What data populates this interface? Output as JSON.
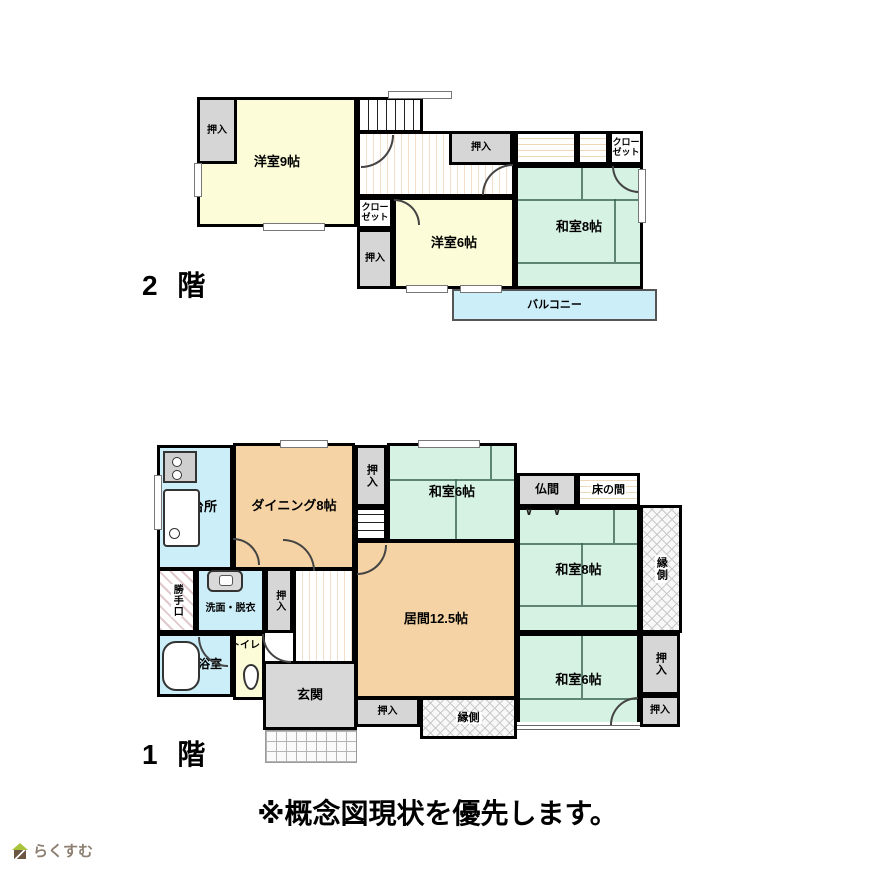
{
  "note": "※概念図現状を優先します。",
  "logo_text": "らくすむ",
  "floor2": {
    "label": "2 階",
    "rooms": {
      "yoshitsu9": "洋室9帖",
      "yoshitsu6": "洋室6帖",
      "washitsu8": "和室8帖",
      "balcony": "バルコニー",
      "closet": "クローゼット",
      "oshiire": "押入"
    }
  },
  "floor1": {
    "label": "1 階",
    "rooms": {
      "kitchen": "台所",
      "dining": "ダイニング8帖",
      "living": "居間12.5帖",
      "washitsu6": "和室6帖",
      "washitsu8": "和室8帖",
      "butsuma": "仏間",
      "butsuma_doors": "∨ ∨",
      "tokonoma": "床の間",
      "engawa": "縁側",
      "oshiire": "押入",
      "kattegu": "勝手口",
      "senmen": "洗面・脱衣",
      "bath": "浴室",
      "toilet": "トイレ",
      "genkan": "玄関"
    }
  },
  "colors": {
    "western_room": "#fdfcd8",
    "japanese_room": "#d6f2e2",
    "dining_living": "#f5d3a5",
    "water_area": "#cbeef8",
    "balcony": "#cbeef8",
    "closet": "#d6d6d6",
    "wall": "#000000"
  }
}
